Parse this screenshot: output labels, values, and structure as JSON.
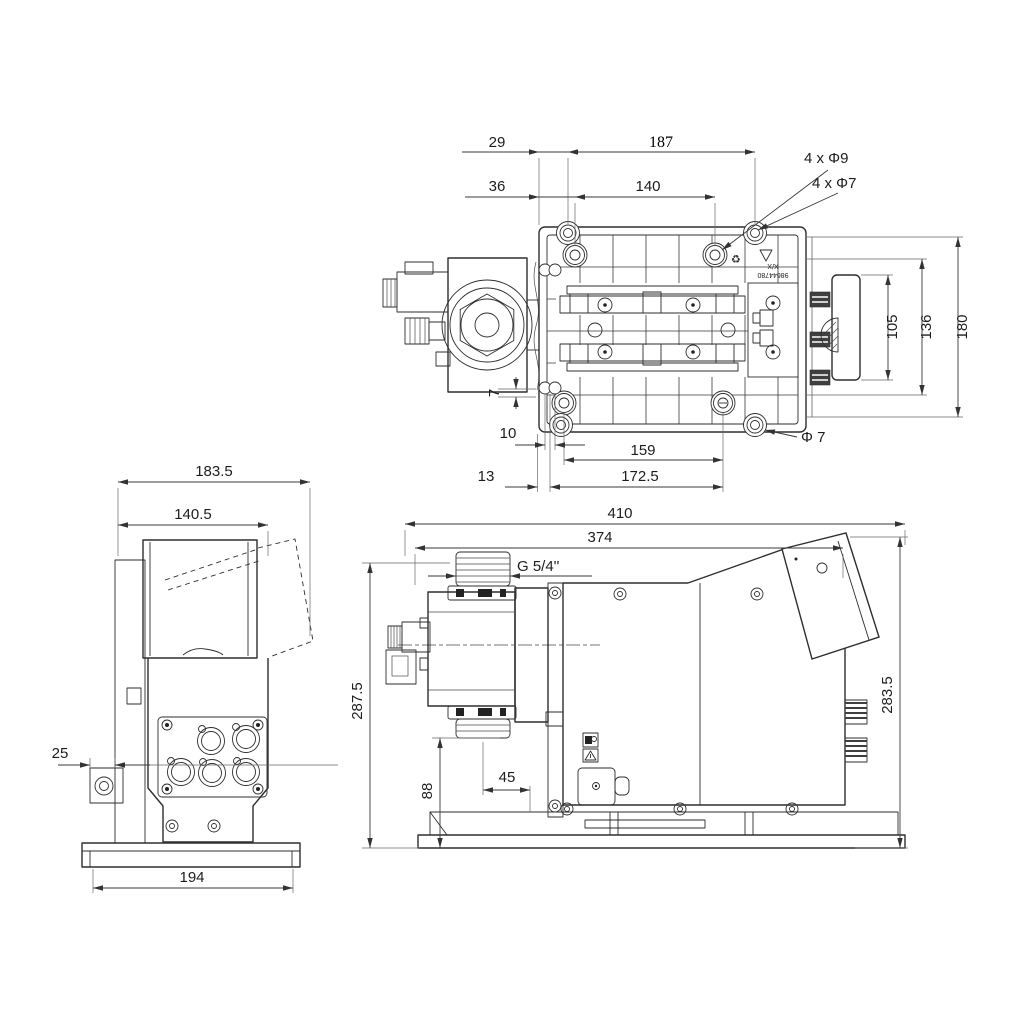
{
  "drawing": {
    "background": "#ffffff",
    "line_color": "#2e2e2e",
    "dim_text_color": "#1d1d1d",
    "top": {
      "dims": {
        "d29": "29",
        "d187": "187",
        "d36": "36",
        "d140": "140",
        "holes9": "4 x Φ9",
        "holes7": "4 x Φ7",
        "d105": "105",
        "d136": "136",
        "d180": "180",
        "d7": "7",
        "d10": "10",
        "d159": "159",
        "phi7": "Φ 7",
        "d13": "13",
        "d172_5": "172.5"
      },
      "marking1": "X/X",
      "marking2": "98644780",
      "recycle_icon": "♻"
    },
    "front": {
      "dims": {
        "d183_5": "183.5",
        "d140_5": "140.5",
        "d25": "25",
        "d194": "194"
      }
    },
    "side": {
      "dims": {
        "d410": "410",
        "d374": "374",
        "thread": "G 5/4''",
        "d287_5": "287.5",
        "d88": "88",
        "d45": "45",
        "d283_5": "283.5"
      }
    }
  }
}
